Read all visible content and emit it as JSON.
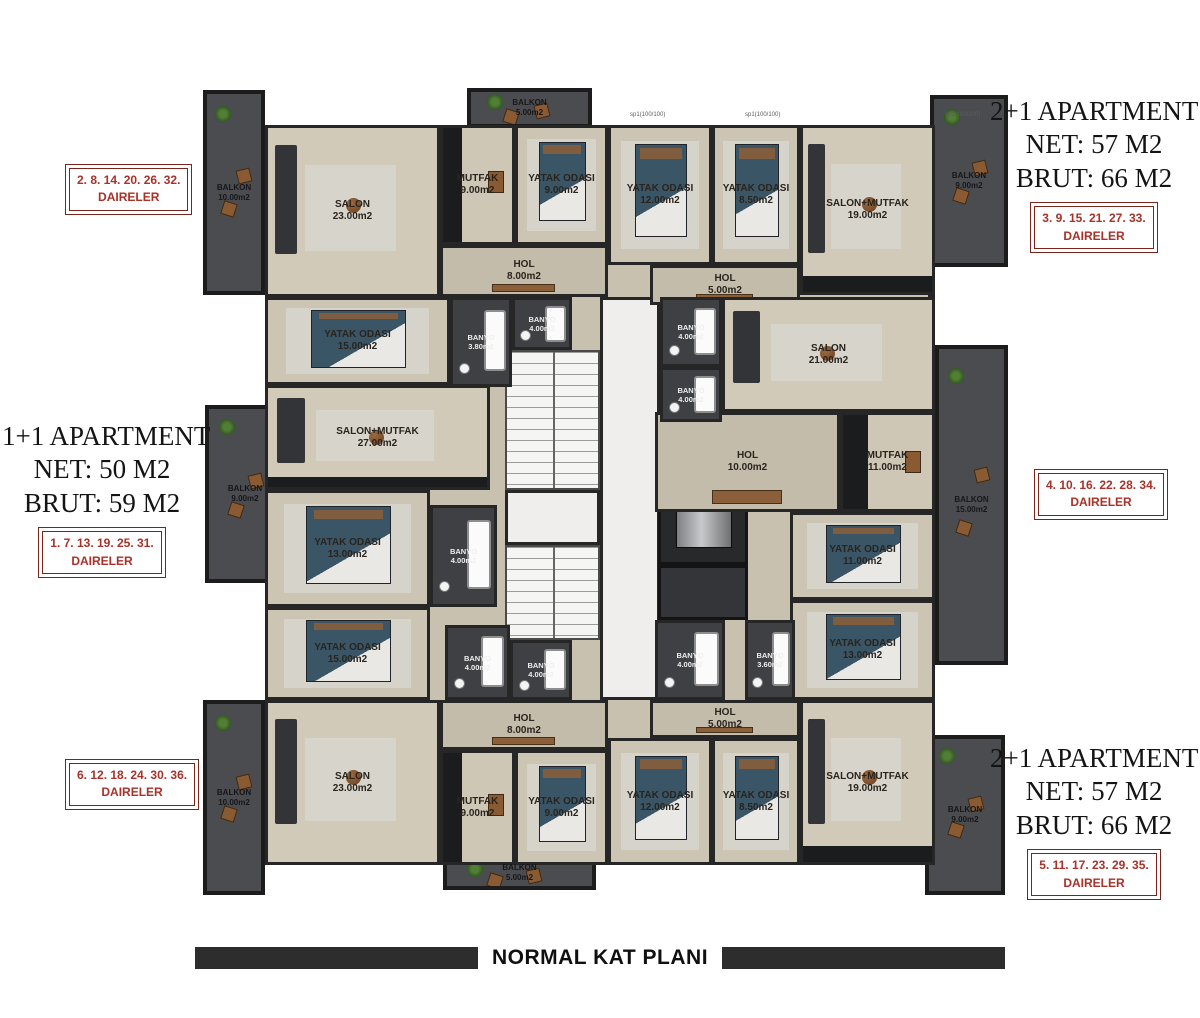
{
  "info_blocks": {
    "top_left": {
      "units": "2. 8. 14. 20. 26. 32.",
      "label": "DAIRELER"
    },
    "top_right": {
      "title": "2+1 APARTMENT",
      "net": "NET: 57 M2",
      "brut": "BRUT: 66 M2",
      "units": "3. 9. 15. 21. 27. 33.",
      "label": "DAIRELER"
    },
    "middle_left": {
      "title": "1+1 APARTMENT",
      "net": "NET: 50 M2",
      "brut": "BRUT: 59 M2",
      "units": "1. 7. 13. 19. 25. 31.",
      "label": "DAIRELER"
    },
    "middle_right": {
      "units": "4. 10. 16. 22. 28. 34.",
      "label": "DAIRELER"
    },
    "bottom_left": {
      "units": "6. 12. 18. 24. 30. 36.",
      "label": "DAIRELER"
    },
    "bottom_right": {
      "title": "2+1 APARTMENT",
      "net": "NET: 57 M2",
      "brut": "BRUT: 66 M2",
      "units": "5. 11. 17. 23. 29. 35.",
      "label": "DAIRELER"
    }
  },
  "footer": {
    "title": "NORMAL KAT PLANI"
  },
  "colors": {
    "accent_red": "#a93129",
    "border_red": "#7a241c",
    "wall": "#262626",
    "floor_beige": "#cdc5b4",
    "balcony_gray": "#4a4c4f",
    "bar_dark": "#2d2d2d"
  },
  "plan": {
    "rooms": [
      {
        "name": "SALON",
        "area": "23.00m2",
        "type": "salon",
        "x": 65,
        "y": 40,
        "w": 175,
        "h": 172
      },
      {
        "name": "MUTFAK",
        "area": "9.00m2",
        "type": "mutfak",
        "x": 240,
        "y": 40,
        "w": 75,
        "h": 120
      },
      {
        "name": "YATAK ODASI",
        "area": "9.00m2",
        "type": "yatak",
        "x": 315,
        "y": 40,
        "w": 93,
        "h": 120
      },
      {
        "name": "YATAK ODASI",
        "area": "12.00m2",
        "type": "yatak",
        "x": 408,
        "y": 40,
        "w": 104,
        "h": 140
      },
      {
        "name": "YATAK ODASI",
        "area": "8.50m2",
        "type": "yatak",
        "x": 512,
        "y": 40,
        "w": 88,
        "h": 140
      },
      {
        "name": "SALON+MUTFAK",
        "area": "19.00m2",
        "type": "salonmutfak",
        "x": 600,
        "y": 40,
        "w": 135,
        "h": 170
      },
      {
        "name": "HOL",
        "area": "8.00m2",
        "type": "hol",
        "x": 240,
        "y": 160,
        "w": 168,
        "h": 52
      },
      {
        "name": "HOL",
        "area": "5.00m2",
        "type": "hol",
        "x": 450,
        "y": 180,
        "w": 150,
        "h": 40
      },
      {
        "name": "YATAK ODASI",
        "area": "15.00m2",
        "type": "yatak",
        "x": 65,
        "y": 212,
        "w": 185,
        "h": 88
      },
      {
        "name": "SALON",
        "area": "21.00m2",
        "type": "salon",
        "x": 522,
        "y": 212,
        "w": 213,
        "h": 115
      },
      {
        "name": "SALON+MUTFAK",
        "area": "27.00m2",
        "type": "salonmutfak",
        "x": 65,
        "y": 300,
        "w": 225,
        "h": 105
      },
      {
        "name": "HOL",
        "area": "10.00m2",
        "type": "hol",
        "x": 455,
        "y": 327,
        "w": 185,
        "h": 100
      },
      {
        "name": "MUTFAK",
        "area": "11.00m2",
        "type": "mutfak",
        "x": 640,
        "y": 327,
        "w": 95,
        "h": 100
      },
      {
        "name": "BANYO",
        "area": "3.80m2",
        "type": "banyo",
        "x": 250,
        "y": 212,
        "w": 62,
        "h": 90
      },
      {
        "name": "BANYO",
        "area": "4.00m2",
        "type": "banyo",
        "x": 312,
        "y": 212,
        "w": 60,
        "h": 53
      },
      {
        "name": "BANYO",
        "area": "4.00m2",
        "type": "banyo",
        "x": 460,
        "y": 212,
        "w": 62,
        "h": 70
      },
      {
        "name": "BANYO",
        "area": "4.00m2",
        "type": "banyo",
        "x": 460,
        "y": 282,
        "w": 62,
        "h": 55
      },
      {
        "name": "YATAK ODASI",
        "area": "13.00m2",
        "type": "yatak",
        "x": 65,
        "y": 405,
        "w": 165,
        "h": 117
      },
      {
        "name": "YATAK ODASI",
        "area": "11.00m2",
        "type": "yatak",
        "x": 590,
        "y": 427,
        "w": 145,
        "h": 88
      },
      {
        "name": "YATAK ODASI",
        "area": "15.00m2",
        "type": "yatak",
        "x": 65,
        "y": 522,
        "w": 165,
        "h": 93
      },
      {
        "name": "YATAK ODASI",
        "area": "13.00m2",
        "type": "yatak",
        "x": 590,
        "y": 515,
        "w": 145,
        "h": 100
      },
      {
        "name": "BANYO",
        "area": "4.00m2",
        "type": "banyo",
        "x": 230,
        "y": 420,
        "w": 67,
        "h": 102
      },
      {
        "name": "BANYO",
        "area": "4.00m2",
        "type": "banyo",
        "x": 245,
        "y": 540,
        "w": 65,
        "h": 75
      },
      {
        "name": "BANYO",
        "area": "4.00m2",
        "type": "banyo",
        "x": 310,
        "y": 555,
        "w": 62,
        "h": 60
      },
      {
        "name": "BANYO",
        "area": "4.00m2",
        "type": "banyo",
        "x": 455,
        "y": 535,
        "w": 70,
        "h": 80
      },
      {
        "name": "BANYO",
        "area": "3.60m2",
        "type": "banyo",
        "x": 545,
        "y": 535,
        "w": 50,
        "h": 80
      },
      {
        "name": "HOL",
        "area": "8.00m2",
        "type": "hol",
        "x": 240,
        "y": 615,
        "w": 168,
        "h": 50
      },
      {
        "name": "HOL",
        "area": "5.00m2",
        "type": "hol",
        "x": 450,
        "y": 615,
        "w": 150,
        "h": 38
      },
      {
        "name": "SALON",
        "area": "23.00m2",
        "type": "salon",
        "x": 65,
        "y": 615,
        "w": 175,
        "h": 165
      },
      {
        "name": "MUTFAK",
        "area": "9.00m2",
        "type": "mutfak",
        "x": 240,
        "y": 665,
        "w": 75,
        "h": 115
      },
      {
        "name": "YATAK ODASI",
        "area": "9.00m2",
        "type": "yatak",
        "x": 315,
        "y": 665,
        "w": 93,
        "h": 115
      },
      {
        "name": "YATAK ODASI",
        "area": "12.00m2",
        "type": "yatak",
        "x": 408,
        "y": 653,
        "w": 104,
        "h": 127
      },
      {
        "name": "YATAK ODASI",
        "area": "8.50m2",
        "type": "yatak",
        "x": 512,
        "y": 653,
        "w": 88,
        "h": 127
      },
      {
        "name": "SALON+MUTFAK",
        "area": "19.00m2",
        "type": "salonmutfak",
        "x": 600,
        "y": 615,
        "w": 135,
        "h": 165
      }
    ],
    "balconies": [
      {
        "name": "BALKON",
        "area": "10.00m2",
        "x": 3,
        "y": 5,
        "w": 62,
        "h": 205
      },
      {
        "name": "BALKON",
        "area": "5.00m2",
        "x": 267,
        "y": 3,
        "w": 125,
        "h": 40
      },
      {
        "name": "BALKON",
        "area": "9.00m2",
        "x": 730,
        "y": 10,
        "w": 78,
        "h": 172
      },
      {
        "name": "BALKON",
        "area": "9.00m2",
        "x": 5,
        "y": 320,
        "w": 80,
        "h": 178
      },
      {
        "name": "BALKON",
        "area": "15.00m2",
        "x": 735,
        "y": 260,
        "w": 73,
        "h": 320
      },
      {
        "name": "BALKON",
        "area": "10.00m2",
        "x": 3,
        "y": 615,
        "w": 62,
        "h": 195
      },
      {
        "name": "BALKON",
        "area": "5.00m2",
        "x": 243,
        "y": 770,
        "w": 153,
        "h": 35
      },
      {
        "name": "BALKON",
        "area": "9.00m2",
        "x": 725,
        "y": 650,
        "w": 80,
        "h": 160
      }
    ],
    "core": [
      {
        "type": "core",
        "x": 400,
        "y": 212,
        "w": 60,
        "h": 403
      },
      {
        "type": "core",
        "x": 305,
        "y": 405,
        "w": 95,
        "h": 55
      },
      {
        "type": "stairs",
        "x": 305,
        "y": 265,
        "w": 95,
        "h": 140
      },
      {
        "type": "stairs",
        "x": 305,
        "y": 460,
        "w": 95,
        "h": 95
      },
      {
        "type": "elevator",
        "x": 458,
        "y": 387,
        "w": 90,
        "h": 93
      },
      {
        "type": "shaft",
        "x": 458,
        "y": 480,
        "w": 90,
        "h": 55
      }
    ],
    "window_labels": [
      {
        "text": "sp1(100/100)",
        "x": 430,
        "y": 27
      },
      {
        "text": "sp1(100/100)",
        "x": 545,
        "y": 27
      },
      {
        "text": "sp1(100/100)",
        "x": 745,
        "y": 27
      }
    ]
  }
}
